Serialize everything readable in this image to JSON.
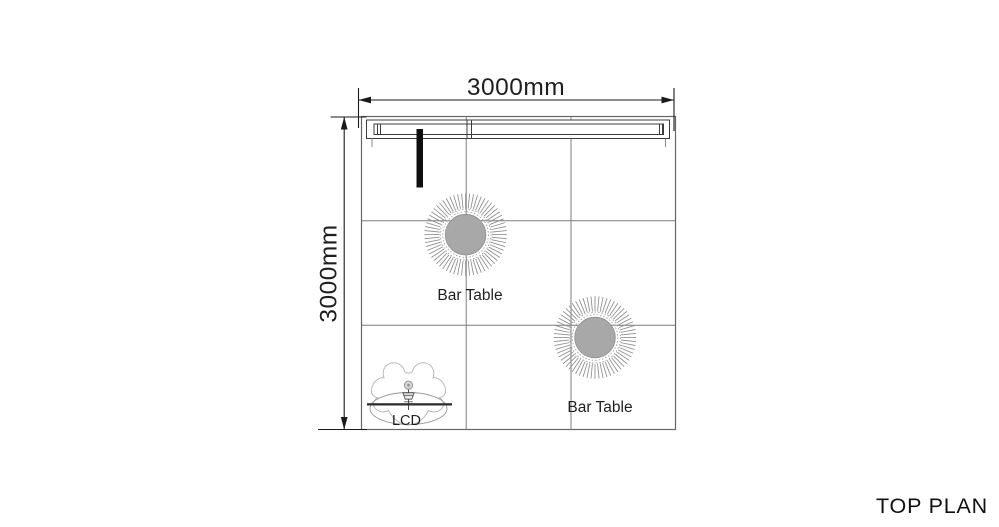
{
  "page": {
    "background": "#ffffff"
  },
  "title": {
    "text": "TOP PLAN"
  },
  "dimensions": {
    "width_label": "3000mm",
    "height_label": "3000mm"
  },
  "furniture": {
    "bar_table_1": {
      "label": "Bar Table"
    },
    "bar_table_2": {
      "label": "Bar Table"
    },
    "lcd": {
      "label": "LCD"
    }
  },
  "colors": {
    "dimension_line": "#1a1a1a",
    "booth_border": "#666666",
    "floor_grid": "#7d7d7d",
    "wall_line": "#3c3c3c",
    "spotlight": "#0f0f0f",
    "table_disc": "#a8a8a8",
    "table_spokes": "#8d8d8d",
    "lcd_outline": "#b3b3b3"
  }
}
